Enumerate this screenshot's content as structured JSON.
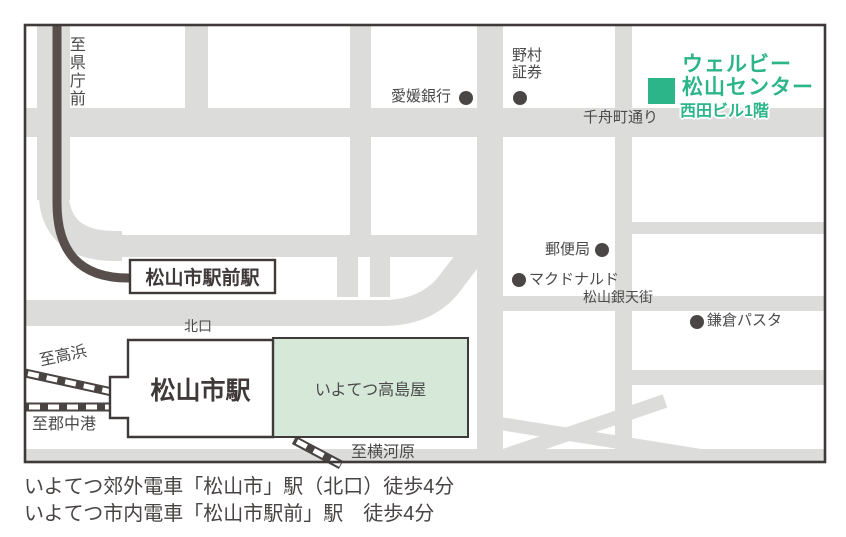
{
  "colors": {
    "road": "#dcdcda",
    "accent_green": "#2db58a",
    "pale_green": "#d6e8d8",
    "frame_dark": "#3f3a39",
    "label_gray": "#4a4a4a",
    "tram_line": "#584f4d",
    "rail_track": "#494442",
    "dot": "#4a4645"
  },
  "map": {
    "destination": {
      "name_line1": "ウェルビー",
      "name_line2": "松山センター",
      "building": "西田ビル1階"
    },
    "streets": {
      "chifunecho": "千舟町通り",
      "gintengai": "松山銀天街"
    },
    "landmarks": {
      "ehime_bank": "愛媛銀行",
      "nomura_line1": "野村",
      "nomura_line2": "証券",
      "post_office": "郵便局",
      "mcdonalds": "マクドナルド",
      "kamakura_pasta": "鎌倉パスタ"
    },
    "stations": {
      "ekimae_station": "松山市駅前駅",
      "matsuyama_station": "松山市駅",
      "takashimaya": "いよてつ高島屋",
      "north_exit": "北口"
    },
    "directions": {
      "to_kencho_mae": "至県庁前",
      "to_takahama": "至高浜",
      "to_gunchuko": "至郡中港",
      "to_yokogawara": "至横河原"
    }
  },
  "captions": {
    "line1": "いよてつ郊外電車「松山市」駅（北口）徒歩4分",
    "line2": "いよてつ市内電車「松山市駅前」駅　徒歩4分"
  }
}
